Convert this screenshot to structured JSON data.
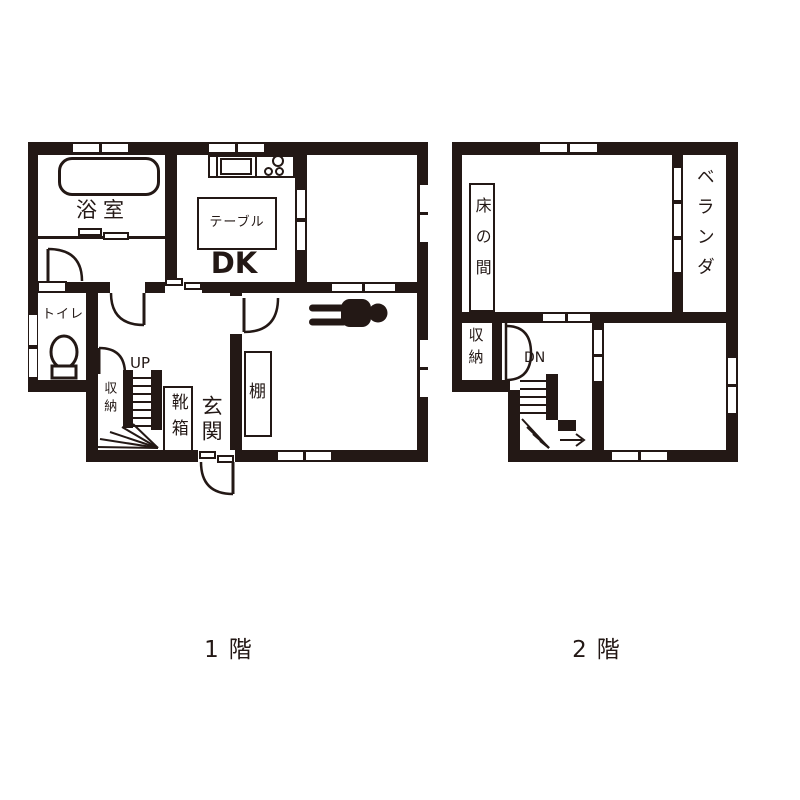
{
  "colors": {
    "wall": "#231815",
    "background": "#ffffff"
  },
  "floor1": {
    "caption": "1階",
    "rooms": {
      "bathroom": "浴室",
      "table": "テーブル",
      "dk": "DK",
      "toilet": "トイレ",
      "stairs_up": "UP",
      "closet": "収納",
      "shoe_box": "靴箱",
      "entrance": "玄関",
      "shelf": "棚"
    }
  },
  "floor2": {
    "caption": "2階",
    "rooms": {
      "tokonoma": "床の間",
      "veranda": "ベランダ",
      "closet": "収納",
      "stairs_down": "DN"
    }
  },
  "icons": {
    "bathtub": "rounded-rectangle",
    "kitchen_sink": "rectangle",
    "stove_burners": "three-circles",
    "toilet_bowl": "ellipse-with-base",
    "sleeping_person": "black-silhouette",
    "doors": "quarter-circle-arcs",
    "stairs": "steps-with-winder-fan",
    "exit_arrow": "right-arrow"
  }
}
